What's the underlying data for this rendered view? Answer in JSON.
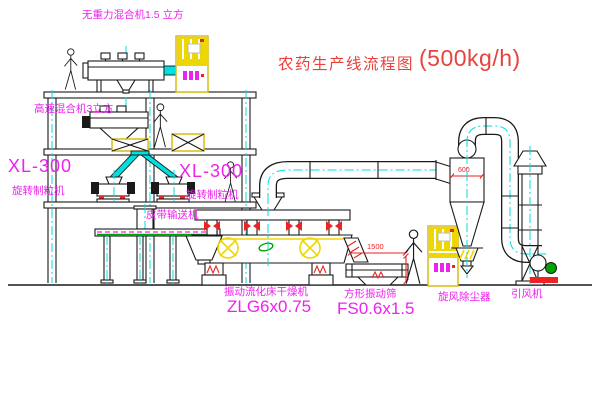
{
  "title": {
    "name": "农药生产线流程图",
    "capacity": "(500kg/h)"
  },
  "equipment_labels": {
    "gravity_mixer": "无重力混合机1.5 立方",
    "high_speed_mixer": "高速混合机3立方",
    "granulator_left_model": "XL-300",
    "granulator_left_name": "旋转制粒机",
    "granulator_right_model": "XL-300",
    "granulator_right_name": "旋转制粒机",
    "belt_conveyor": "皮带输送机",
    "fluid_bed_dryer_name": "振动流化床干燥机",
    "fluid_bed_dryer_model": "ZLG6x0.75",
    "vibrating_sieve_name": "方形振动筛",
    "vibrating_sieve_model": "FS0.6x1.5",
    "cyclone_dust_collector": "旋风除尘器",
    "induced_draft_fan": "引风机"
  },
  "dimensions": {
    "sieve_length": "1500",
    "cyclone_diameter": "600"
  },
  "colors": {
    "magenta": "#ee22ee",
    "red": "#ee2222",
    "title_red": "#e8423c",
    "cyan": "#00dede",
    "yellow": "#eed700",
    "yellow_dk": "#d6ba00",
    "green": "#00a400"
  }
}
